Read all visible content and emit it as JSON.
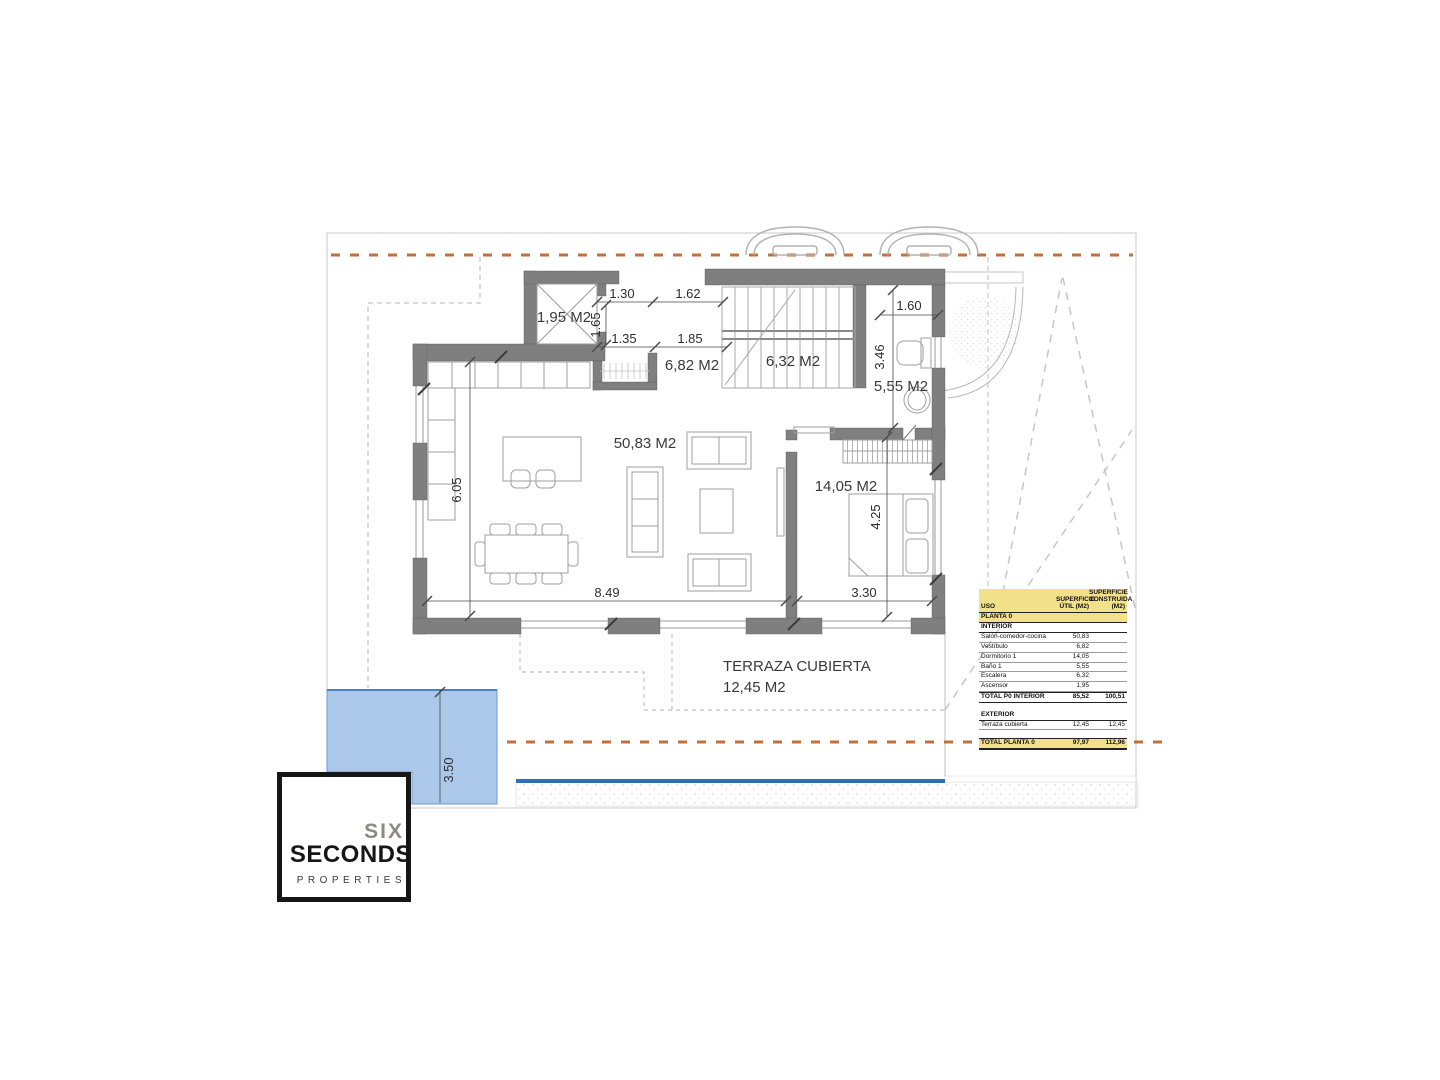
{
  "plan": {
    "rooms": {
      "ascensor": "1,95 M2",
      "vestibulo": "6,82 M2",
      "escalera": "6,32 M2",
      "bano": "5,55 M2",
      "salon": "50,83 M2",
      "dormitorio": "14,05 M2",
      "terraza_name": "TERRAZA CUBIERTA",
      "terraza_area": "12,45 M2"
    },
    "dims": {
      "hall_top_left": "1.30",
      "hall_top_right": "1.62",
      "hall_height": "1.65",
      "hall_bottom_left": "1.35",
      "hall_bottom_right": "1.85",
      "bath_width": "1.60",
      "bath_height": "3.46",
      "living_height": "6.05",
      "living_width": "8.49",
      "bedroom_width": "3.30",
      "bedroom_height": "4.25",
      "pool_width": "3.50"
    }
  },
  "table": {
    "headers": {
      "uso": "USO",
      "util": "SUPERFICIE ÚTIL (M2)",
      "construida": "SUPERFICIE CONSTRUIDA (M2)"
    },
    "planta_header": "PLANTA 0",
    "interior_header": "INTERIOR",
    "interior_rows": [
      {
        "uso": "Salón-comedor-cocina",
        "util": "50,83",
        "cons": ""
      },
      {
        "uso": "Vestíbulo",
        "util": "6,82",
        "cons": ""
      },
      {
        "uso": "Dormitorio 1",
        "util": "14,05",
        "cons": ""
      },
      {
        "uso": "Baño 1",
        "util": "5,55",
        "cons": ""
      },
      {
        "uso": "Escalera",
        "util": "6,32",
        "cons": ""
      },
      {
        "uso": "Ascensor",
        "util": "1,95",
        "cons": ""
      }
    ],
    "total_interior": {
      "uso": "TOTAL P0 INTERIOR",
      "util": "85,52",
      "cons": "100,51"
    },
    "exterior_header": "EXTERIOR",
    "exterior_rows": [
      {
        "uso": "Terraza cubierta",
        "util": "12,45",
        "cons": "12,45"
      }
    ],
    "total_planta": {
      "uso": "TOTAL PLANTA 0",
      "util": "97,97",
      "cons": "112,96"
    }
  },
  "logo": {
    "six": "SIX",
    "seconds": "SECONDS",
    "properties": "PROPERTIES"
  },
  "colors": {
    "boundary_dash": "#c2703d",
    "wall": "#7f7f7f",
    "pool_fill": "#abc8eb",
    "pool_line": "#2f6fba",
    "table_yellow": "#f3e08b"
  }
}
